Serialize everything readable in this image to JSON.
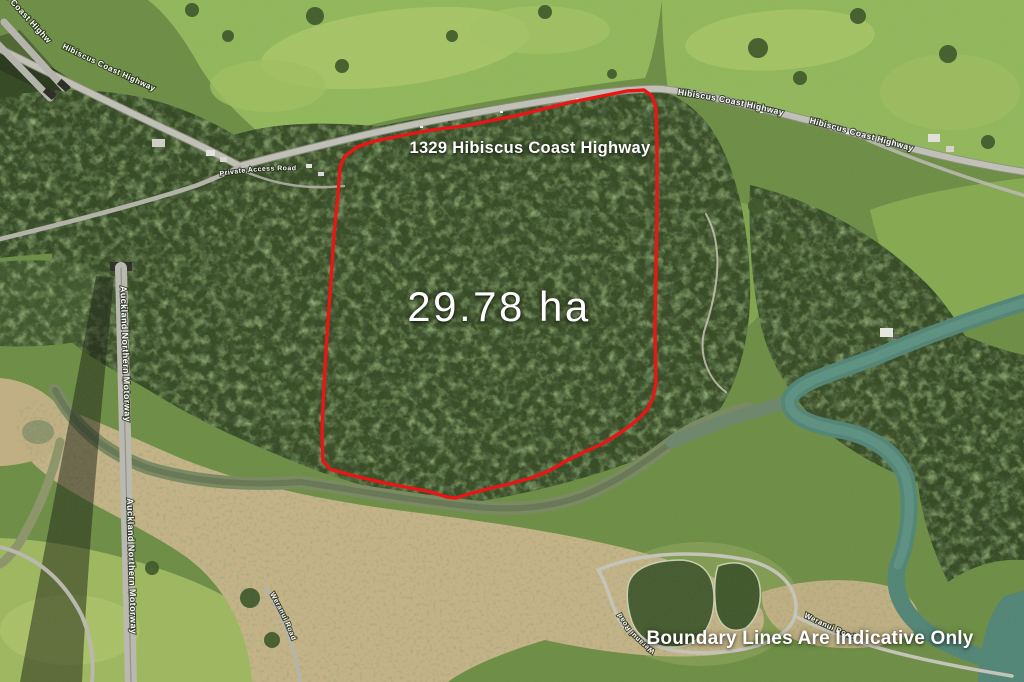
{
  "overlay": {
    "address": "1329 Hibiscus Coast Highway",
    "area": "29.78 ha",
    "disclaimer": "Boundary Lines Are Indicative Only",
    "text_color": "#ffffff"
  },
  "boundary": {
    "color": "#e81616",
    "points": "340,168 344,157 357,147 375,141 400,136 432,130 464,126 494,120 515,116 543,109 572,102 602,96 627,91 644,90 652,96 656,108 657,150 657,210 656,270 655,330 656,382 653,398 647,410 636,421 620,433 602,444 584,452 566,461 549,471 531,478 509,484 487,489 469,494 456,498 447,497 431,492 411,488 390,484 367,479 347,474 330,469 323,461 322,430 324,385 327,335 331,280 334,235 338,195 340,168"
  },
  "roads": {
    "hibiscus_coast_highway": "Hibiscus Coast Highway",
    "auckland_northern_motorway": "Auckland Northern Motorway",
    "private_access_road": "Private Access Road",
    "weranui_road": "Weranui Road"
  },
  "palette": {
    "boundary_red": "#e81616",
    "label_white": "#ffffff",
    "forest_dark": "#31461f",
    "pasture_green": "#8fb757",
    "sand": "#c4b284",
    "estuary_water": "#77875d",
    "river_teal": "#4e8374",
    "pond_green": "#41582a",
    "road_gray": "#c0c0b6"
  }
}
